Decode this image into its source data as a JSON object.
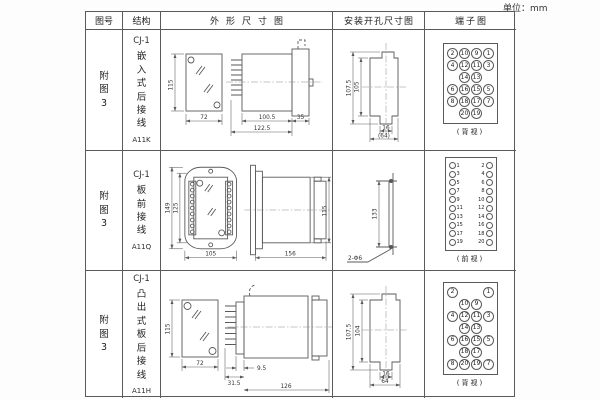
{
  "unit_label": "单位：mm",
  "line_color": "#5a5a5a",
  "table": {
    "headers": {
      "fig_no": "图号",
      "structure": "结构",
      "outline": "外形尺寸图",
      "install": "安装开孔尺寸图",
      "terminal": "端子图"
    },
    "rows": [
      {
        "fig_no": "附图3",
        "model": "CJ-1",
        "structure": "嵌入式后接线",
        "code": "A11K",
        "outline": {
          "front_height": "115",
          "front_width": "72",
          "body_length": "100.5",
          "total_length": "122.5",
          "flange": "35"
        },
        "install": {
          "outer_height": "107.5",
          "inner_height": "105",
          "slot_width": "16",
          "total_width": "(64)"
        },
        "terminal": {
          "type": "back-grid",
          "label": "(背视)",
          "rows": [
            [
              "2",
              "10",
              "9",
              "1"
            ],
            [
              "4",
              "12",
              "11",
              "3"
            ],
            [
              "",
              "14",
              "13",
              ""
            ],
            [
              "6",
              "16",
              "15",
              "5"
            ],
            [
              "8",
              "18",
              "17",
              "7"
            ],
            [
              "",
              "20",
              "19",
              ""
            ]
          ]
        }
      },
      {
        "fig_no": "附图3",
        "model": "CJ-1",
        "structure": "板前接线",
        "code": "A11Q",
        "outline": {
          "front_height": "149",
          "inner_height": "125",
          "front_width": "105",
          "side_length": "156",
          "side_height": "115"
        },
        "install": {
          "hole_pitch": "133",
          "holes_label": "2-Φ6"
        },
        "terminal": {
          "type": "front-pairs",
          "label": "(前视)",
          "pairs": [
            [
              "1",
              "2"
            ],
            [
              "3",
              "4"
            ],
            [
              "5",
              "6"
            ],
            [
              "7",
              "8"
            ],
            [
              "9",
              "10"
            ],
            [
              "11",
              "12"
            ],
            [
              "13",
              "14"
            ],
            [
              "15",
              "16"
            ],
            [
              "17",
              "18"
            ],
            [
              "19",
              "20"
            ]
          ]
        }
      },
      {
        "fig_no": "附图3",
        "model": "CJ-1",
        "structure": "凸出式板后接线",
        "code": "A11H",
        "outline": {
          "front_height": "115",
          "front_width": "72",
          "pin_offset": "9.5",
          "pin_section": "31.5",
          "body_length": "126"
        },
        "install": {
          "outer_height": "107.5",
          "inner_height": "104",
          "slot_width": "16",
          "total_width": "64"
        },
        "terminal": {
          "type": "back-grid",
          "label": "(背视)",
          "rows": [
            [
              "2",
              "",
              "",
              "1"
            ],
            [
              "",
              "10",
              "9",
              ""
            ],
            [
              "4",
              "12",
              "11",
              "3"
            ],
            [
              "",
              "14",
              "13",
              ""
            ],
            [
              "6",
              "16",
              "15",
              "5"
            ],
            [
              "",
              "18",
              "17",
              ""
            ],
            [
              "8",
              "20",
              "19",
              "7"
            ]
          ]
        }
      }
    ]
  }
}
